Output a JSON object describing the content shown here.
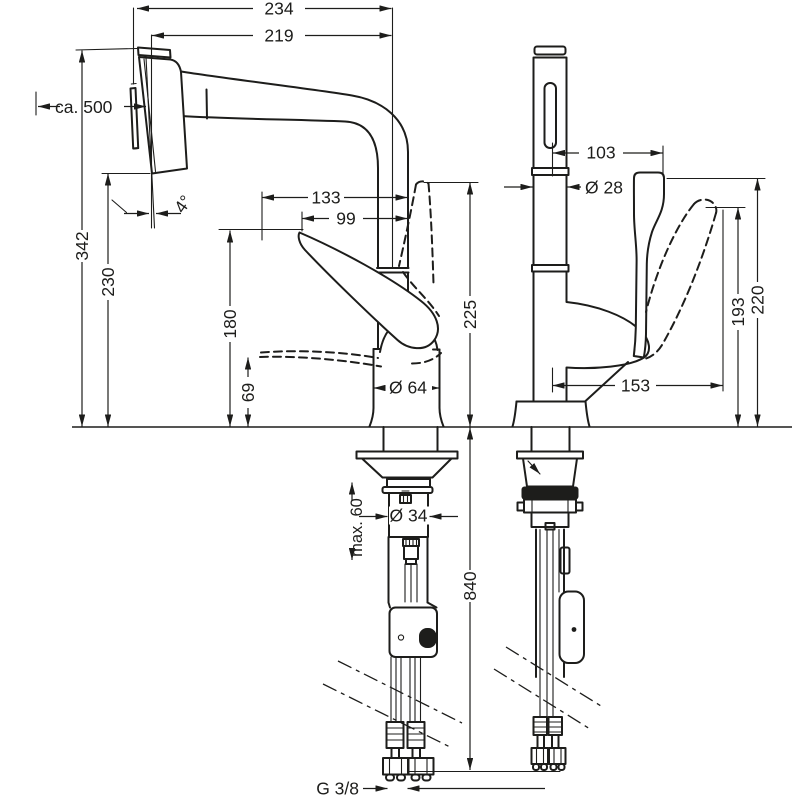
{
  "drawing": {
    "type": "technical-dimension-drawing",
    "subject": "kitchen mixer tap with pull-out spray, side view and front view with installation parts",
    "ink_color": "#1d1d1b",
    "background_color": "#ffffff"
  },
  "dims": {
    "overall_reach": "234",
    "spout_reach": "219",
    "hose_length": "ca. 500",
    "spout_height": "342",
    "outlet_height": "230",
    "spray_angle": "4°",
    "handle_reach_133": "133",
    "handle_reach_99": "99",
    "handle_top_height": "225",
    "handle_height_180": "180",
    "handle_height_69": "69",
    "body_diameter": "Ø 64",
    "max_deck_thickness": "max. 60",
    "shaft_diameter": "Ø 34",
    "hose_drop": "840",
    "connection_thread": "G 3/8",
    "front_offset": "103",
    "spout_diameter": "Ø 28",
    "handle_front_193": "193",
    "handle_front_220": "220",
    "handle_front_reach": "153"
  }
}
